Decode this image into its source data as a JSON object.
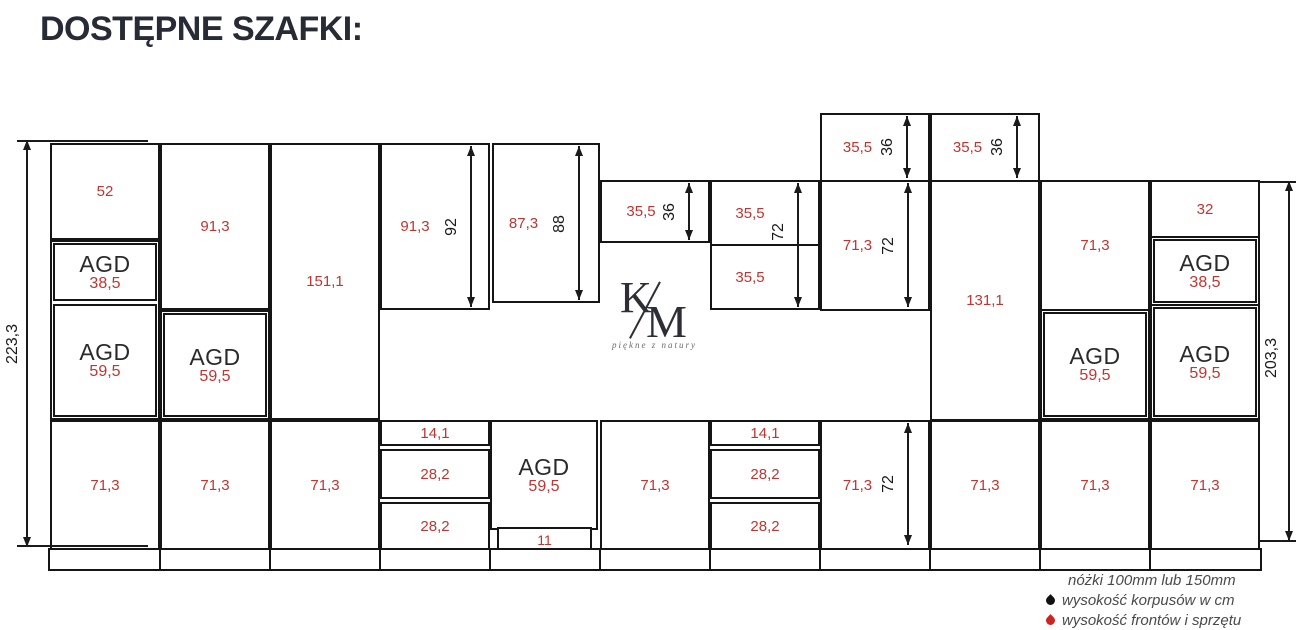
{
  "title": "DOSTĘPNE SZAFKI:",
  "logo": {
    "letter_k": "K",
    "letter_m": "M",
    "tagline": "piękne z natury"
  },
  "colors": {
    "front_height_red": "#c23430",
    "carcass_black": "#1a1a1a"
  },
  "agd_label": "AGD",
  "cabinets": {
    "c1_top": "52",
    "c1_agd_upper": "38,5",
    "c1_agd_lower": "59,5",
    "c2_top": "91,3",
    "c2_agd": "59,5",
    "c3_tall": "151,1",
    "c4_top": "91,3",
    "c5_top": "87,3",
    "c6_wall": "35,5",
    "c7_wall_top": "35,5",
    "c7_wall_bottom": "35,5",
    "c8_top": "35,5",
    "c8_wall": "71,3",
    "c9_top": "35,5",
    "c9_tall": "131,1",
    "c10_wall": "71,3",
    "c10_agd": "59,5",
    "c11_top": "32",
    "c11_agd_upper": "38,5",
    "c11_agd_lower": "59,5",
    "base_c1": "71,3",
    "base_c2": "71,3",
    "base_c3": "71,3",
    "c4_drawer1": "14,1",
    "c4_drawer2": "28,2",
    "c4_drawer3": "28,2",
    "c5_agd": "59,5",
    "c5_plinth": "11",
    "base_c6": "71,3",
    "c7_drawer1": "14,1",
    "c7_drawer2": "28,2",
    "c7_drawer3": "28,2",
    "base_c8": "71,3",
    "base_c9": "71,3",
    "base_c10": "71,3",
    "base_c11": "71,3"
  },
  "dims": {
    "total_left": "223,3",
    "total_right": "203,3",
    "c4_height": "92",
    "c5_height": "88",
    "c6_height": "36",
    "c7_height": "72",
    "c8_top_height": "36",
    "c9_top_height": "36",
    "c8_wall_height": "72",
    "c8_base_height": "72"
  },
  "legend": {
    "legs": "nóżki 100mm lub 150mm",
    "carcass": "wysokość korpusów w cm",
    "fronts": "wysokość frontów i sprzętu"
  }
}
